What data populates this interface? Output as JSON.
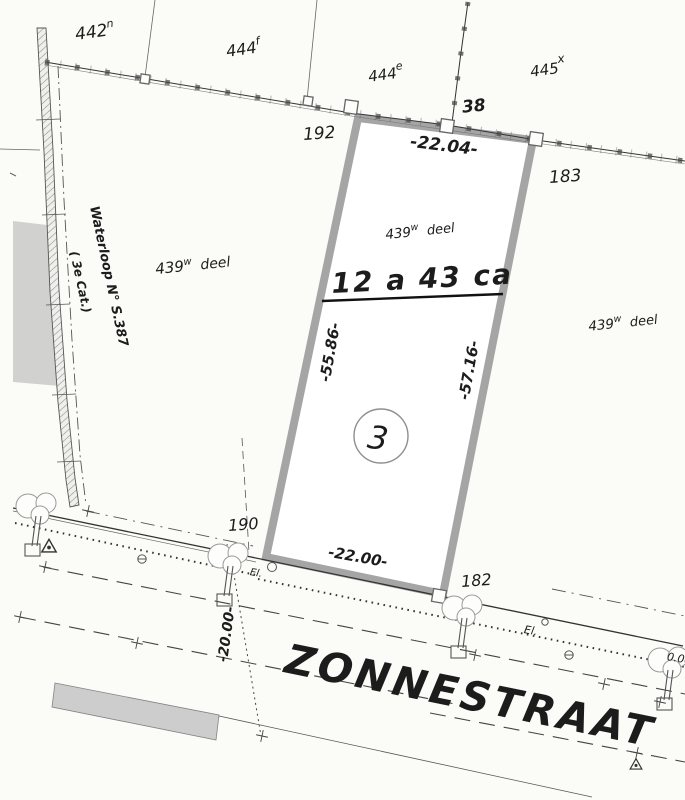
{
  "colors": {
    "paper": "#fbfbf8",
    "ink": "#1c1c1c",
    "parcel_border": "#a5a5a5",
    "light_gray": "#c9c9c9",
    "hatch_gray": "#8a8a8a"
  },
  "parcels": {
    "p442": {
      "base": "442",
      "sup": "n"
    },
    "p444f": {
      "base": "444",
      "sup": "f"
    },
    "p444e": {
      "base": "444",
      "sup": "e"
    },
    "p445": {
      "base": "445",
      "sup": "x"
    },
    "deel_left": {
      "base": "439",
      "sup": "w",
      "name": " deel"
    },
    "deel_center": {
      "base": "439",
      "sup": "w",
      "name": " deel"
    },
    "deel_right": {
      "base": "439",
      "sup": "w",
      "name": " deel"
    }
  },
  "lot": {
    "number": "3",
    "area": "12 a 43 ca"
  },
  "points": {
    "p38": "38",
    "p192": "192",
    "p183": "183",
    "p190": "190",
    "p182": "182"
  },
  "dimensions": {
    "top": "-22.04-",
    "bottom": "-22.00-",
    "left": "-55.86-",
    "right": "-57.16-",
    "depth": "-20.00-",
    "edge_partial": "0.00"
  },
  "waterway": {
    "line1": "Waterloop N° S.387",
    "line2": "( 3e Cat.)"
  },
  "street": {
    "name": "ZONNESTRAAT"
  },
  "trees": {
    "label_west": "El.",
    "label_east": "El."
  }
}
